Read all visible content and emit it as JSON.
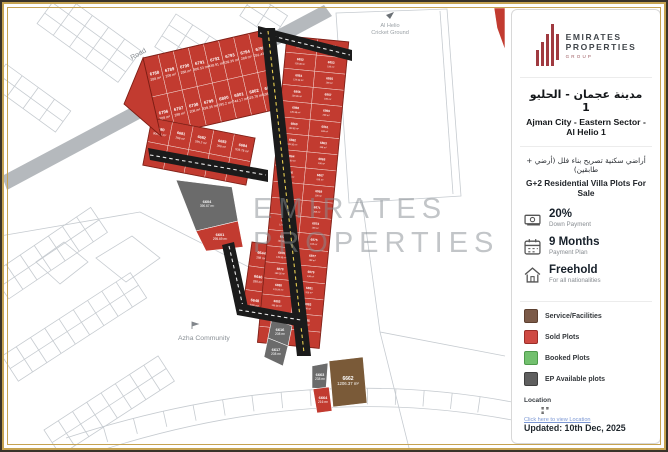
{
  "panel": {
    "logo": {
      "line1": "EMIRATES",
      "line2": "PROPERTIES",
      "line3": "GROUP"
    },
    "title_ar": "مدينة عجمان - الحليو 1",
    "title_en": "Ajman City - Eastern Sector - Al Helio 1",
    "subtitle_ar": "أراضي سكنية تصريح بناء فلل (أرضي + طابقين)",
    "subtitle_en": "G+2 Residential Villa Plots For Sale",
    "features": [
      {
        "icon": "banknote-icon",
        "label": "20%",
        "sublabel": "Down Payment"
      },
      {
        "icon": "calendar-icon",
        "label": "9 Months",
        "sublabel": "Payment Plan"
      },
      {
        "icon": "house-icon",
        "label": "Freehold",
        "sublabel": "For all nationalities"
      }
    ],
    "legend": [
      {
        "color": "#7b5a48",
        "border": "#5d4030",
        "label": "Service/Facilities"
      },
      {
        "color": "#cf4a43",
        "border": "#9c2e28",
        "label": "Sold Plots"
      },
      {
        "color": "#72c06e",
        "border": "#4e9a4b",
        "label": "Booked Plots"
      },
      {
        "color": "#5f5f5f",
        "border": "#3f3f3f",
        "label": "EP Available plots"
      }
    ],
    "location_label": "Location",
    "location_link": "Click here to view Location",
    "updated": "Updated:  10th Dec, 2025"
  },
  "map": {
    "labels": {
      "road": "Road",
      "cricket_ground_1": "Al Helio",
      "cricket_ground_2": "Cricket Ground",
      "community": "Azha Community",
      "watermark_1": "EMIRATES",
      "watermark_2": "PROPERTIES"
    },
    "colors": {
      "sold": "#c23b30",
      "sold_edge": "#7e1d14",
      "available": "#6b6b6b",
      "service": "#7a5a38",
      "road": "#1b1b1b",
      "road_dash": "#e9cf52",
      "gray_road": "#b5b9bd",
      "context": "#c6cbd0",
      "watermark": "#878d92"
    },
    "clusters": [
      {
        "tx": 143,
        "ty": 58,
        "rot": -13,
        "cols": 8,
        "rows": 2,
        "cw": 15.5,
        "ch": 40,
        "plots": [
          {
            "n": "6788",
            "a": "288 m²"
          },
          {
            "n": "6789",
            "a": "208 m²"
          },
          {
            "n": "6790",
            "a": "288 m²"
          },
          {
            "n": "6791",
            "a": "306.53 m²"
          },
          {
            "n": "6792",
            "a": "438.91 m²"
          },
          {
            "n": "6793",
            "a": "339.35 m²"
          },
          {
            "n": "6794",
            "a": "288 m²"
          },
          {
            "n": "6795",
            "a": "291.43 m²"
          },
          {
            "n": "6796",
            "a": "208 m²"
          },
          {
            "n": "6797",
            "a": "288 m²"
          },
          {
            "n": "6798",
            "a": "208 m²"
          },
          {
            "n": "6799",
            "a": "339.35 m²"
          },
          {
            "n": "6800",
            "a": "295.2 m²"
          },
          {
            "n": "6801",
            "a": "744.17 m²"
          },
          {
            "n": "6802",
            "a": "528.78 m²"
          },
          {
            "n": "6803",
            "a": "438.91 m²"
          }
        ]
      },
      {
        "tx": 152,
        "ty": 118,
        "rot": 11,
        "cols": 5,
        "rows": 2,
        "cw": 21,
        "ch": 24,
        "plots": [
          {
            "n": "6680",
            "a": "306.53 m²"
          },
          {
            "n": "6681",
            "a": "288 m²"
          },
          {
            "n": "6682",
            "a": "295.2 m²"
          },
          {
            "n": "6683",
            "a": "208 m²"
          },
          {
            "n": "6684",
            "a": "528.78 m²"
          },
          {
            "n": "6685",
            "a": "208 m²"
          },
          {
            "n": "6686",
            "a": "288 m²"
          },
          {
            "n": "6687",
            "a": "208 m²"
          },
          {
            "n": "6688",
            "a": "206.53 m²"
          },
          {
            "n": "6689",
            "a": "288 m²"
          }
        ]
      },
      {
        "tx": 252,
        "ty": 242,
        "rot": 8,
        "cols": 2,
        "rows": 3,
        "cw": 22,
        "ch": 24,
        "plots": [
          {
            "n": "6644",
            "a": "288 m²"
          },
          {
            "n": "6645",
            "a": "208 m²"
          },
          {
            "n": "6646",
            "a": "288 m²"
          },
          {
            "n": "6647",
            "a": "208 m²"
          },
          {
            "n": "6648",
            "a": "288 m²"
          },
          {
            "n": "6649",
            "a": "208 m²"
          }
        ]
      },
      {
        "tx": 287,
        "ty": 36,
        "rot": 5.5,
        "cols": 2,
        "rows": 19,
        "cw": 31,
        "ch": 16.2,
        "plots": [
          {
            "n": "6850",
            "a": "139.35 m²"
          },
          {
            "n": "6851",
            "a": "198 m²"
          },
          {
            "n": "6852",
            "a": "139.35 m²"
          },
          {
            "n": "6853",
            "a": "198 m²"
          },
          {
            "n": "6854",
            "a": "129.99 m²"
          },
          {
            "n": "6855",
            "a": "198 m²"
          },
          {
            "n": "6856",
            "a": "139.35 m²"
          },
          {
            "n": "6857",
            "a": "198 m²"
          },
          {
            "n": "6858",
            "a": "139.35 m²"
          },
          {
            "n": "6859",
            "a": "208 m²"
          },
          {
            "n": "6860",
            "a": "139.35 m²"
          },
          {
            "n": "6861",
            "a": "198 m²"
          },
          {
            "n": "6862",
            "a": "139.35 m²"
          },
          {
            "n": "6863",
            "a": "198 m²"
          },
          {
            "n": "6864",
            "a": "129.99 m²"
          },
          {
            "n": "6865",
            "a": "198 m²"
          },
          {
            "n": "6866",
            "a": "139.35 m²"
          },
          {
            "n": "6867",
            "a": "198 m²"
          },
          {
            "n": "6868",
            "a": "139.35 m²"
          },
          {
            "n": "6869",
            "a": "198 m²"
          },
          {
            "n": "6870",
            "a": "139.35 m²"
          },
          {
            "n": "6871",
            "a": "208 m²"
          },
          {
            "n": "6872",
            "a": "129.99 m²"
          },
          {
            "n": "6873",
            "a": "198 m²"
          },
          {
            "n": "6874",
            "a": "139.35 m²"
          },
          {
            "n": "6875",
            "a": "198 m²"
          },
          {
            "n": "6876",
            "a": "139.35 m²"
          },
          {
            "n": "6877",
            "a": "198 m²"
          },
          {
            "n": "6878",
            "a": "139.35 m²"
          },
          {
            "n": "6879",
            "a": "198 m²"
          },
          {
            "n": "6880",
            "a": "129.99 m²"
          },
          {
            "n": "6881",
            "a": "208 m²"
          },
          {
            "n": "6882",
            "a": "139.35 m²"
          },
          {
            "n": "6883",
            "a": "198 m²"
          },
          {
            "n": "6884",
            "a": "238.99 m²"
          },
          {
            "n": "6885",
            "a": "198 m²"
          },
          {
            "n": "6886",
            "a": "195 m²"
          },
          {
            "n": "6887",
            "a": "238.99 m²"
          }
        ]
      }
    ],
    "singles": [
      {
        "type": "available",
        "pts": "176,180 232,187 238,221 196,231",
        "n": "6604",
        "a": "390.67 m²",
        "lx": 207,
        "ly": 203
      },
      {
        "type": "sold",
        "pts": "196,231 238,221 243,247 206,251",
        "n": "6601",
        "a": "295.69 m²",
        "lx": 220,
        "ly": 236
      },
      {
        "type": "available",
        "pts": "272,318 292,326 288,346 268,338",
        "n": "6616",
        "a": "208 m²",
        "lx": 280,
        "ly": 331
      },
      {
        "type": "available",
        "pts": "268,338 288,346 283,366 264,357",
        "n": "6617",
        "a": "208 m²",
        "lx": 276,
        "ly": 351
      },
      {
        "type": "available",
        "pts": "312,366 328,363 326,389 312,388",
        "n": "6663",
        "a": "238 m²",
        "lx": 320,
        "ly": 376
      },
      {
        "type": "sold",
        "pts": "313,389 329,387 332,411 317,413",
        "n": "6664",
        "a": "216 m²",
        "lx": 323,
        "ly": 399
      },
      {
        "type": "service",
        "pts": "329,361 363,357 367,403 333,407",
        "n": "6662",
        "a": "1206.37 m²",
        "lx": 348,
        "ly": 380,
        "big": true
      },
      {
        "type": "sold",
        "pts": "494,8 505,8 505,50 497,28",
        "n": "",
        "a": ""
      }
    ]
  }
}
